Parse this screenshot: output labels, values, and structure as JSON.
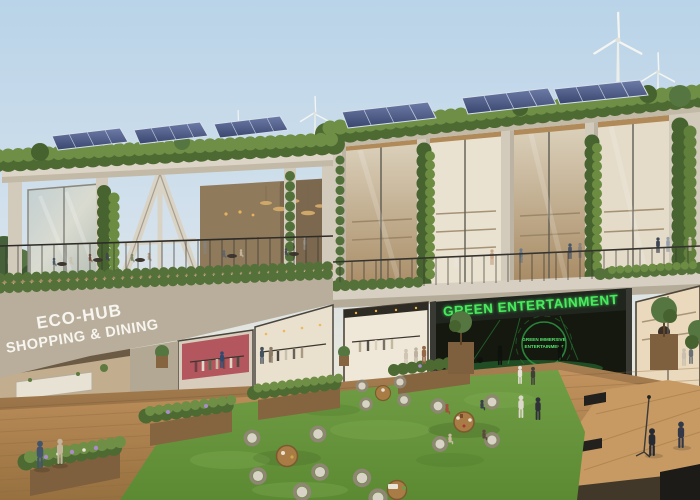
{
  "scene": {
    "title": "Architectural rendering of a two-storey eco shopping and dining hub with green roofs, rooftop solar panels, wind turbines, terrace dining, glass storefronts, a lawn courtyard with wicker seating and an outdoor wooden stage",
    "signs": {
      "eco_hub_line1": "ECO-HUB",
      "eco_hub_line2": "SHOPPING & DINING",
      "green_entertainment": "GREEN ENTERTAINMENT",
      "logo_line1": "GREEN IMMERSIVE",
      "logo_line2": "ENTERTAINMENT"
    },
    "palette": {
      "sky_top": "#bfd7e8",
      "sky_horizon": "#efead9",
      "concrete": "#d5cec0",
      "concrete_shadow": "#b2a894",
      "vegetation_dark": "#4e6a33",
      "vegetation_light": "#6f8f46",
      "solar_panel": "#46527c",
      "glass": "#c7cfc9",
      "wood_deck": "#b58854",
      "grass": "#6d9a41",
      "neon_green": "#3ddc52",
      "sign_white": "#f7f5ef",
      "storefront_dark": "#1d221b",
      "pink_interior": "#b4565e"
    }
  }
}
